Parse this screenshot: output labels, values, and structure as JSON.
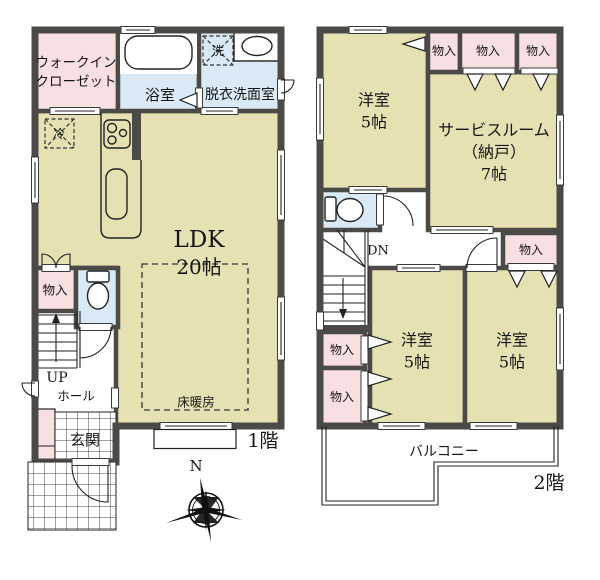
{
  "colors": {
    "wall": "#4c4a47",
    "room_tatami_tan": "#e6e1b2",
    "closet_pink": "#f8dfe2",
    "wet_area_blue": "#d9eaf6",
    "line": "#222222"
  },
  "floor1": {
    "label": "1階",
    "walk_in_closet_line1": "ウォークイン",
    "walk_in_closet_line2": "クローゼット",
    "bathroom": "浴室",
    "washroom": "脱衣洗面室",
    "washer_symbol": "洗",
    "fridge_symbol": "冷",
    "ldk_name": "LDK",
    "ldk_size": "20帖",
    "floor_heating": "床暖房",
    "storage": "物入",
    "stairs_up": "UP",
    "hall": "ホール",
    "entrance": "玄関",
    "compass_north": "N"
  },
  "floor2": {
    "label": "2階",
    "western_room": "洋室",
    "western_room_size": "5帖",
    "service_room_line1": "サービスルーム",
    "service_room_line2": "（納戸）",
    "service_room_line3": "7帖",
    "storage": "物入",
    "stairs_down": "DN",
    "balcony": "バルコニー"
  }
}
